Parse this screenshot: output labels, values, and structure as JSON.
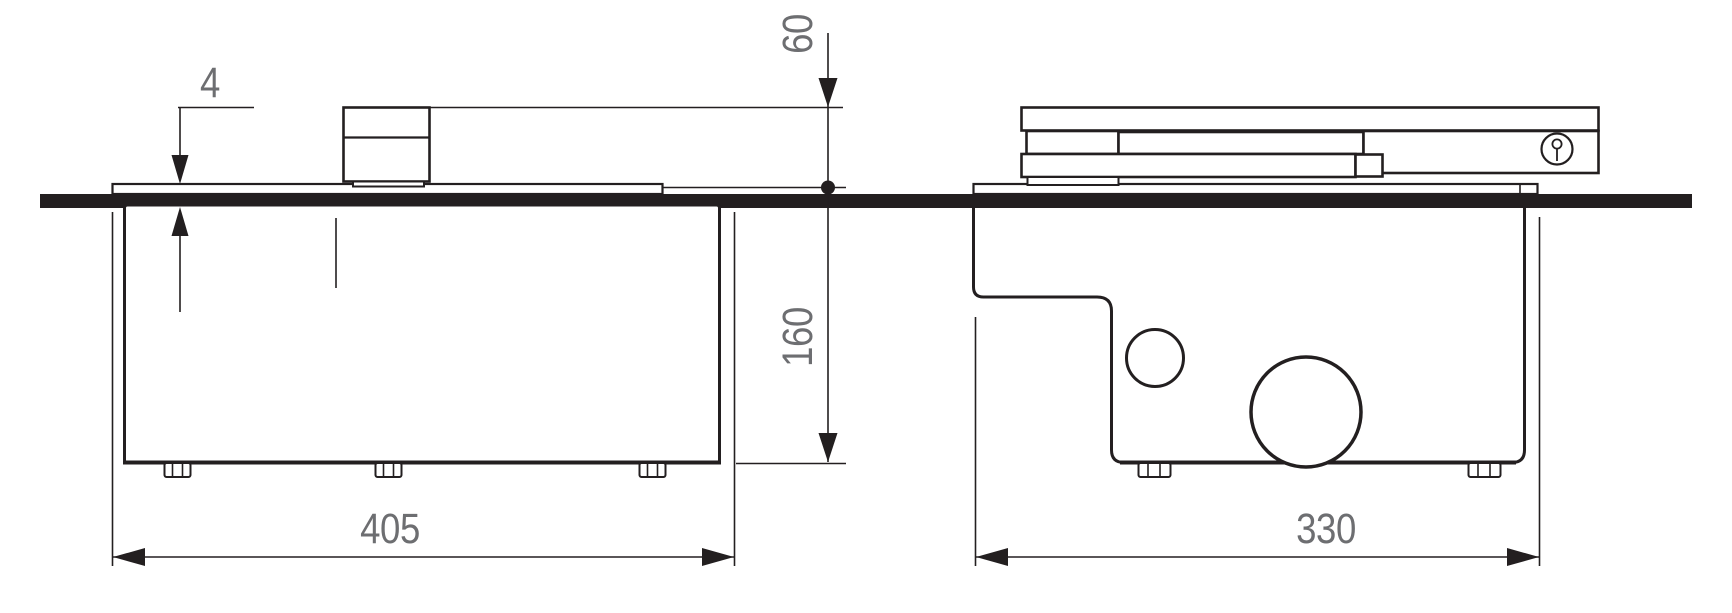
{
  "dimensions": {
    "proud_height": {
      "label": "4"
    },
    "height_above_worktop": {
      "label": "60"
    },
    "depth_below_worktop": {
      "label": "160"
    },
    "width_front_view": {
      "label": "405"
    },
    "width_side_view": {
      "label": "330"
    }
  },
  "icons": {
    "fastener": "keyhole-screw-icon"
  },
  "colors": {
    "line": "#231f20",
    "dim_text": "#6d6e71",
    "background": "#ffffff"
  }
}
